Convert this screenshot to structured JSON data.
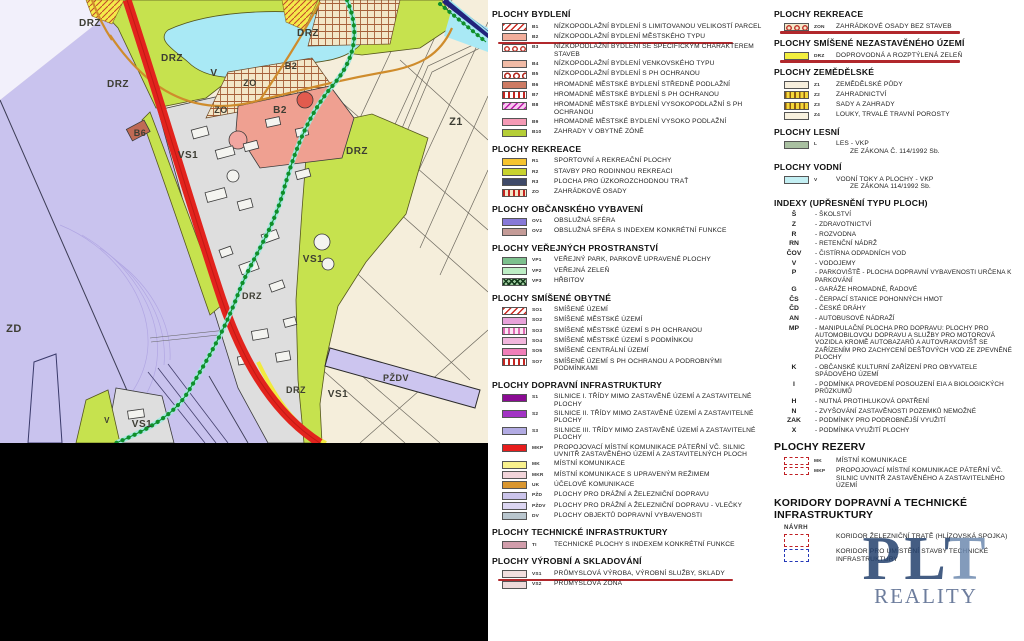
{
  "map": {
    "colors": {
      "background_beige": "#f5eedb",
      "lavender_zd": "#c9c3ee",
      "green_drz": "#c6e24e",
      "water_cyan": "#a9e9f5",
      "road_red": "#e2231d",
      "gray_vs1": "#dedede",
      "salmon_b2": "#efa091",
      "orange_road": "#cf8c2c",
      "chain_green": "#0f8f2a",
      "hatch_beige": "#f3e7c8",
      "black_bar": "#000000"
    },
    "labels": [
      {
        "text": "DRZ",
        "x": 90,
        "y": 26,
        "size": 10
      },
      {
        "text": "DRZ",
        "x": 172,
        "y": 61,
        "size": 10
      },
      {
        "text": "DRZ",
        "x": 118,
        "y": 87,
        "size": 10
      },
      {
        "text": "DRZ",
        "x": 308,
        "y": 36,
        "size": 10
      },
      {
        "text": "DRZ",
        "x": 357,
        "y": 154,
        "size": 10
      },
      {
        "text": "DRZ",
        "x": 252,
        "y": 299,
        "size": 9
      },
      {
        "text": "DRZ",
        "x": 296,
        "y": 393,
        "size": 9
      },
      {
        "text": "V",
        "x": 214,
        "y": 76,
        "size": 10
      },
      {
        "text": "V",
        "x": 107,
        "y": 423,
        "size": 8
      },
      {
        "text": "ZO",
        "x": 250,
        "y": 86,
        "size": 9
      },
      {
        "text": "ZO",
        "x": 221,
        "y": 113,
        "size": 9
      },
      {
        "text": "B2",
        "x": 291,
        "y": 69,
        "size": 9
      },
      {
        "text": "B2",
        "x": 280,
        "y": 113,
        "size": 10
      },
      {
        "text": "B6",
        "x": 140,
        "y": 136,
        "size": 9
      },
      {
        "text": "Z1",
        "x": 456,
        "y": 125,
        "size": 11
      },
      {
        "text": "ZD",
        "x": 14,
        "y": 332,
        "size": 11
      },
      {
        "text": "VS1",
        "x": 188,
        "y": 158,
        "size": 10
      },
      {
        "text": "VS1",
        "x": 313,
        "y": 262,
        "size": 10
      },
      {
        "text": "VS1",
        "x": 338,
        "y": 397,
        "size": 10
      },
      {
        "text": "VS1",
        "x": 142,
        "y": 427,
        "size": 10
      },
      {
        "text": "PŽDV",
        "x": 396,
        "y": 381,
        "size": 9
      }
    ]
  },
  "legend": {
    "columns": [
      {
        "id": "col1",
        "sections": [
          {
            "title": "PLOCHY BYDLENÍ",
            "items": [
              {
                "code": "B1",
                "swatch": {
                  "pattern": "diag-red",
                  "fill": "#ffffff"
                },
                "label": "NÍZKOPODLAŽNÍ BYDLENÍ S LIMITOVANOU VELIKOSTÍ PARCEL"
              },
              {
                "code": "B2",
                "swatch": {
                  "pattern": "solid",
                  "fill": "#f2ae9b"
                },
                "label": "NÍZKOPODLAŽNÍ BYDLENÍ MĚSTSKÉHO TYPU",
                "underline": true
              },
              {
                "code": "B3",
                "swatch": {
                  "pattern": "circles-red",
                  "fill": "#ffffff"
                },
                "label": "NÍZKOPODLAŽNÍ BYDLENÍ SE SPECIFICKÝM CHARAKTEREM STAVEB"
              },
              {
                "code": "B4",
                "swatch": {
                  "pattern": "solid",
                  "fill": "#f1bba6"
                },
                "label": "NÍZKOPODLAŽNÍ BYDLENÍ VENKOVSKÉHO TYPU"
              },
              {
                "code": "B5",
                "swatch": {
                  "pattern": "circles-red-lg",
                  "fill": "#ffffff"
                },
                "label": "NÍZKOPODLAŽNÍ BYDLENÍ S PH OCHRANOU"
              },
              {
                "code": "B6",
                "swatch": {
                  "pattern": "solid",
                  "fill": "#cd7b64"
                },
                "label": "HROMADNÉ MĚSTSKÉ BYDLENÍ STŘEDNĚ PODLAŽNÍ"
              },
              {
                "code": "B7",
                "swatch": {
                  "pattern": "vstripes-red",
                  "fill": "#ffffff"
                },
                "label": "HROMADNÉ MĚSTSKÉ BYDLENÍ S PH OCHRANOU"
              },
              {
                "code": "B8",
                "swatch": {
                  "pattern": "diag-magenta",
                  "fill": "#f7c8ee"
                },
                "label": "HROMADNÉ MĚSTSKÉ BYDLENÍ VYSOKOPODLAŽNÍ S PH OCHRANOU"
              },
              {
                "code": "B9",
                "swatch": {
                  "pattern": "solid",
                  "fill": "#f59ab5"
                },
                "label": "HROMADNÉ MĚSTSKÉ BYDLENÍ VYSOKO PODLAŽNÍ"
              },
              {
                "code": "B10",
                "swatch": {
                  "pattern": "solid",
                  "fill": "#b5ce37"
                },
                "label": "ZAHRADY V OBYTNÉ ZÓNĚ"
              }
            ]
          },
          {
            "title": "PLOCHY REKREACE",
            "items": [
              {
                "code": "R1",
                "swatch": {
                  "pattern": "solid",
                  "fill": "#f6c42f"
                },
                "label": "SPORTOVNÍ A REKREAČNÍ PLOCHY"
              },
              {
                "code": "R2",
                "swatch": {
                  "pattern": "solid",
                  "fill": "#c9d32e"
                },
                "label": "STAVBY PRO RODINNOU REKREACI"
              },
              {
                "code": "R3",
                "swatch": {
                  "pattern": "solid",
                  "fill": "#3f4a69"
                },
                "label": "PLOCHA PRO ÚZKOROZCHODNOU TRAŤ"
              },
              {
                "code": "ZO",
                "swatch": {
                  "pattern": "vstripes-red-beige",
                  "fill": "#f3e7c8"
                },
                "label": "ZAHRÁDKOVÉ OSADY"
              }
            ]
          },
          {
            "title": "PLOCHY OBČANSKÉHO VYBAVENÍ",
            "items": [
              {
                "code": "OV1",
                "swatch": {
                  "pattern": "solid",
                  "fill": "#8779d8"
                },
                "label": "OBSLUŽNÁ SFÉRA"
              },
              {
                "code": "OV2",
                "swatch": {
                  "pattern": "solid",
                  "fill": "#c49b97"
                },
                "label": "OBSLUŽNÁ SFÉRA S INDEXEM KONKRÉTNÍ FUNKCE"
              }
            ]
          },
          {
            "title": "PLOCHY VEŘEJNÝCH PROSTRANSTVÍ",
            "items": [
              {
                "code": "VP1",
                "swatch": {
                  "pattern": "solid",
                  "fill": "#7cc08d"
                },
                "label": "VEŘEJNÝ PARK, PARKOVĚ UPRAVENÉ PLOCHY"
              },
              {
                "code": "VP2",
                "swatch": {
                  "pattern": "solid",
                  "fill": "#bdeec5"
                },
                "label": "VEŘEJNÁ ZELEŇ"
              },
              {
                "code": "VP3",
                "swatch": {
                  "pattern": "crosshatch-green",
                  "fill": "#9cc79c"
                },
                "label": "HŘBITOV"
              }
            ]
          },
          {
            "title": "PLOCHY SMÍŠENÉ OBYTNÉ",
            "items": [
              {
                "code": "SO1",
                "swatch": {
                  "pattern": "diag-red",
                  "fill": "#ffffff"
                },
                "label": "SMÍŠENÉ ÚZEMÍ"
              },
              {
                "code": "SO2",
                "swatch": {
                  "pattern": "solid",
                  "fill": "#e8a2da"
                },
                "label": "SMÍŠENÉ MĚSTSKÉ ÚZEMÍ"
              },
              {
                "code": "SO3",
                "swatch": {
                  "pattern": "vstripes-pink",
                  "fill": "#fbe6f3"
                },
                "label": "SMÍŠENÉ MĚSTSKÉ ÚZEMÍ S PH OCHRANOU"
              },
              {
                "code": "SO4",
                "swatch": {
                  "pattern": "solid",
                  "fill": "#f2b6dd"
                },
                "label": "SMÍŠENÉ MĚSTSKÉ ÚZEMÍ S PODMÍNKOU"
              },
              {
                "code": "SO5",
                "swatch": {
                  "pattern": "solid",
                  "fill": "#f07fb9"
                },
                "label": "SMÍŠENÉ CENTRÁLNÍ ÚZEMÍ"
              },
              {
                "code": "SO7",
                "swatch": {
                  "pattern": "vstripes-red",
                  "fill": "#ffffff"
                },
                "label": "SMÍŠENÉ ÚZEMÍ S PH OCHRANOU A PODROBNÝMI PODMÍNKAMI"
              }
            ]
          },
          {
            "title": "PLOCHY DOPRAVNÍ INFRASTRUKTURY",
            "items": [
              {
                "code": "S1",
                "swatch": {
                  "pattern": "solid",
                  "fill": "#8a0b93"
                },
                "label": "SILNICE I. TŘÍDY MIMO ZASTAVĚNÉ ÚZEMÍ A ZASTAVITELNÉ PLOCHY"
              },
              {
                "code": "S2",
                "swatch": {
                  "pattern": "solid",
                  "fill": "#a233c4"
                },
                "label": "SILNICE II. TŘÍDY MIMO ZASTAVĚNÉ ÚZEMÍ A ZASTAVITELNÉ PLOCHY"
              },
              {
                "code": "S3",
                "swatch": {
                  "pattern": "solid",
                  "fill": "#b2abe3"
                },
                "label": "SILNICE III. TŘÍDY MIMO ZASTAVĚNÉ ÚZEMÍ A ZASTAVITELNÉ PLOCHY"
              },
              {
                "code": "MKP",
                "swatch": {
                  "pattern": "solid",
                  "fill": "#e71d1c"
                },
                "label": "PROPOJOVACÍ MÍSTNÍ KOMUNIKACE PÁTEŘNÍ VČ. SILNIC UVNITŘ ZASTAVĚNÉHO ÚZEMÍ A ZASTAVITELNÝCH PLOCH"
              },
              {
                "code": "MK",
                "swatch": {
                  "pattern": "solid",
                  "fill": "#f9f18c"
                },
                "label": "MÍSTNÍ KOMUNIKACE"
              },
              {
                "code": "MKR",
                "swatch": {
                  "pattern": "solid",
                  "fill": "#f2d4da"
                },
                "label": "MÍSTNÍ KOMUNIKACE S UPRAVENÝM REŽIMEM"
              },
              {
                "code": "UK",
                "swatch": {
                  "pattern": "solid",
                  "fill": "#d9962f"
                },
                "label": "ÚČELOVÉ KOMUNIKACE"
              },
              {
                "code": "PŽD",
                "swatch": {
                  "pattern": "solid",
                  "fill": "#cbc4eb"
                },
                "label": "PLOCHY PRO DRÁŽNÍ A ŽELEZNIČNÍ DOPRAVU"
              },
              {
                "code": "PŽDV",
                "swatch": {
                  "pattern": "solid",
                  "fill": "#dcd6f2"
                },
                "label": "PLOCHY PRO DRÁŽNÍ A ŽELEZNIČNÍ DOPRAVU - VLEČKY"
              },
              {
                "code": "DV",
                "swatch": {
                  "pattern": "solid",
                  "fill": "#b9c6ce"
                },
                "label": "PLOCHY OBJEKTŮ DOPRAVNÍ VYBAVENOSTI"
              }
            ]
          },
          {
            "title": "PLOCHY TECHNICKÉ INFRASTRUKTURY",
            "items": [
              {
                "code": "TI",
                "swatch": {
                  "pattern": "solid",
                  "fill": "#d19dab"
                },
                "label": "TECHNICKÉ PLOCHY S INDEXEM KONKRÉTNÍ FUNKCE"
              }
            ]
          },
          {
            "title": "PLOCHY VÝROBNÍ A SKLADOVÁNÍ",
            "items": [
              {
                "code": "VS1",
                "swatch": {
                  "pattern": "solid",
                  "fill": "#f2dfdf"
                },
                "label": "PRŮMYSLOVÁ VÝROBA, VÝROBNÍ SLUŽBY, SKLADY",
                "underline": true
              },
              {
                "code": "VS2",
                "swatch": {
                  "pattern": "solid",
                  "fill": "#eedada"
                },
                "label": "PRŮMYSLOVÁ ZÓNA"
              }
            ]
          }
        ]
      },
      {
        "id": "col2",
        "sections": [
          {
            "title": "PLOCHY REKREACE",
            "items": [
              {
                "code": "ZON",
                "swatch": {
                  "pattern": "circles-red-beige",
                  "fill": "#f3e7c8"
                },
                "label": "ZAHRÁDKOVÉ OSADY BEZ STAVEB",
                "underline": true
              }
            ]
          },
          {
            "title": "PLOCHY SMÍŠENÉ NEZASTAVĚNÉHO ÚZEMÍ",
            "items": [
              {
                "code": "DRZ",
                "swatch": {
                  "pattern": "solid",
                  "fill": "#f2ef3e"
                },
                "label": "DOPROVODNÁ A ROZPTÝLENÁ ZELEŇ",
                "underline": true
              }
            ]
          },
          {
            "title": "PLOCHY ZEMĚDĚLSKÉ",
            "items": [
              {
                "code": "Z1",
                "swatch": {
                  "pattern": "solid",
                  "fill": "#f7efdd"
                },
                "label": "ZEMĚDĚLSKÉ PŮDY"
              },
              {
                "code": "Z2",
                "swatch": {
                  "pattern": "vstripes-yellow",
                  "fill": "#f5d83a"
                },
                "label": "ZAHRADNICTVÍ"
              },
              {
                "code": "Z3",
                "swatch": {
                  "pattern": "vstripes-yellow",
                  "fill": "#f5d83a"
                },
                "label": "SADY A ZAHRADY"
              },
              {
                "code": "Z4",
                "swatch": {
                  "pattern": "solid",
                  "fill": "#f8f1de"
                },
                "label": "LOUKY, TRVALÉ TRAVNÍ POROSTY"
              }
            ]
          },
          {
            "title": "PLOCHY LESNÍ",
            "items": [
              {
                "code": "L",
                "swatch": {
                  "pattern": "solid",
                  "fill": "#a9c0a1"
                },
                "label": "LES - VKP",
                "label2": "ZE ZÁKONA Č. 114/1992 Sb."
              }
            ]
          },
          {
            "title": "PLOCHY VODNÍ",
            "items": [
              {
                "code": "V",
                "swatch": {
                  "pattern": "solid",
                  "fill": "#c3eff3"
                },
                "label": "VODNÍ TOKY A PLOCHY - VKP",
                "label2": "ZE ZÁKONA 114/1992 Sb."
              }
            ]
          },
          {
            "title": "INDEXY (UPŘESNĚNÍ TYPU PLOCH)",
            "type": "index",
            "items": [
              {
                "code": "Š",
                "text": "- ŠKOLSTVÍ"
              },
              {
                "code": "Z",
                "text": "- ZDRAVOTNICTVÍ"
              },
              {
                "code": "R",
                "text": "- ROZVODNA"
              },
              {
                "code": "RN",
                "text": "- RETENČNÍ NÁDRŽ"
              },
              {
                "code": "ČOV",
                "text": "- ČISTÍRNA ODPADNÍCH VOD"
              },
              {
                "code": "V",
                "text": "- VODOJEMY"
              },
              {
                "code": "P",
                "text": "- PARKOVIŠTĚ - PLOCHA DOPRAVNÍ VYBAVENOSTI URČENA K PARKOVÁNÍ"
              },
              {
                "code": "G",
                "text": "- GARÁŽE HROMADNÉ, ŘADOVÉ"
              },
              {
                "code": "ČS",
                "text": "- ČERPACÍ STANICE POHONNÝCH HMOT"
              },
              {
                "code": "ČD",
                "text": "- ČESKÉ DRÁHY"
              },
              {
                "code": "AN",
                "text": "- AUTOBUSOVÉ NÁDRAŽÍ"
              },
              {
                "code": "MP",
                "text": "- MANIPULAČNÍ PLOCHA PRO DOPRAVU: PLOCHY PRO AUTOMOBILOVOU DOPRAVU A SLUŽBY PRO MOTOROVÁ VOZIDLA KROMĚ AUTOBAZARŮ A AUTOVRAKOVIŠŤ SE ZAŘÍZENÍM PRO ZACHYCENÍ DEŠŤOVÝCH VOD ZE ZPEVNĚNÉ PLOCHY"
              },
              {
                "code": "K",
                "text": "- OBČANSKÉ KULTURNÍ ZAŘÍZENÍ PRO OBYVATELE SPÁDOVÉHO ÚZEMÍ"
              },
              {
                "code": "I",
                "text": "- PODMÍNKA PROVEDENÍ POSOUZENÍ EIA A BIOLOGICKÝCH PRŮZKUMŮ"
              },
              {
                "code": "H",
                "text": "- NUTNÁ PROTIHLUKOVÁ OPATŘENÍ"
              },
              {
                "code": "N",
                "text": "- ZVYŠOVÁNÍ ZASTAVĚNOSTI POZEMKŮ NEMOŽNÉ"
              },
              {
                "code": "ZAK",
                "text": "- PODMÍNKY PRO PODROBNĚJŠÍ VYUŽITÍ"
              },
              {
                "code": "X",
                "text": "- PODMÍNKA VYUŽITÍ PLOCHY"
              }
            ]
          },
          {
            "title": "PLOCHY REZERV",
            "big": true,
            "items": [
              {
                "code": "MK",
                "swatch": {
                  "pattern": "dashed-red",
                  "fill": "#ffffff"
                },
                "label": "MÍSTNÍ KOMUNIKACE"
              },
              {
                "code": "MKP",
                "swatch": {
                  "pattern": "dashed-red",
                  "fill": "#ffffff"
                },
                "label": "PROPOJOVACÍ MÍSTNÍ KOMUNIKACE PÁTEŘNÍ VČ. SILNIC UVNITŘ ZASTAVĚNÉHO A ZASTAVITELNÉHO ÚZEMÍ"
              }
            ]
          },
          {
            "title": "KORIDORY DOPRAVNÍ A TECHNICKÉ INFRASTRUKTURY",
            "big": true,
            "note": "NÁVRH",
            "items": [
              {
                "code": "",
                "swatch": {
                  "pattern": "bracket-red",
                  "fill": "none"
                },
                "label": "KORIDOR ŽELEZNIČNÍ TRATĚ (HLÍZOVSKÁ SPOJKA)"
              },
              {
                "code": "",
                "swatch": {
                  "pattern": "bracket-blue",
                  "fill": "none"
                },
                "label": "KORIDOR PRO UMÍSTĚNÍ STAVBY TECHNICKÉ INFRASTRUKTURY"
              }
            ]
          }
        ]
      }
    ]
  },
  "watermark": {
    "line1": "PLT",
    "line2": "REALITY"
  }
}
